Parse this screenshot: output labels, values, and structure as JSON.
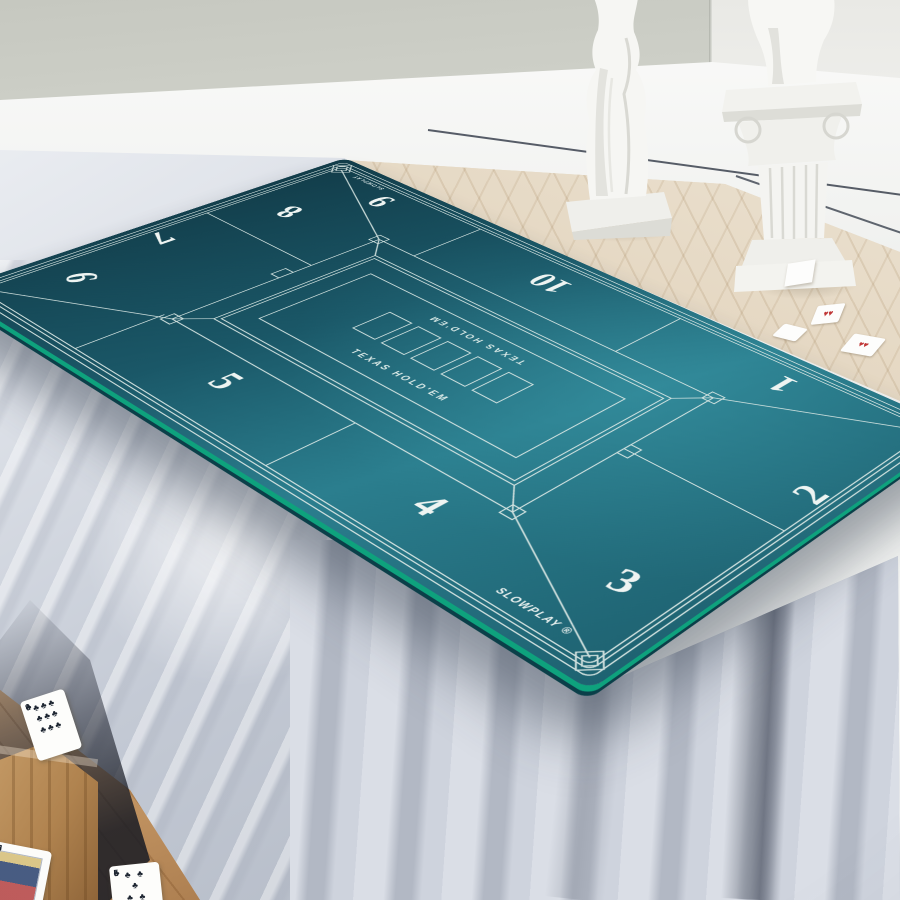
{
  "mat": {
    "brand_small": "SLOWPLAY",
    "brand_main": "SLOWPLAY ®",
    "label_far": "TEXAS HOLD'EM",
    "label_near": "TEXAS HOLD'EM",
    "seats": [
      "1",
      "2",
      "3",
      "4",
      "5",
      "6",
      "7",
      "8",
      "9",
      "10"
    ],
    "colors": {
      "surface": "#1d6070",
      "surface_dark": "#123c49",
      "surface_light": "#2b7e8e",
      "line": "#d8e6e3",
      "edge_band": "#0ea27d"
    }
  },
  "floor_cards": {
    "nine_clubs": {
      "rank": "9",
      "suit": "♣",
      "pip_rows": [
        "♣♣♣",
        "♣♣♣",
        "♣♣♣"
      ]
    },
    "five_clubs": {
      "rank": "5",
      "suit": "♣",
      "pip_rows": [
        "♣ ♣",
        "♣",
        "♣ ♣"
      ]
    },
    "jack_spades": {
      "rank": "J",
      "suit": "♠"
    },
    "tiny_card_pips": "♥♥"
  },
  "room": {
    "colors": {
      "wall": "#c6c8c0",
      "wall_right": "#e9e9e5",
      "baseboard": "#f4f5f3",
      "baseboard_trim_line": "#39414d",
      "floor_herringbone": "#e6dbc7",
      "floor_warm_wood": "#c89d6e",
      "tablecloth": "#c4cad5",
      "statue": "#f5f5f2"
    }
  }
}
